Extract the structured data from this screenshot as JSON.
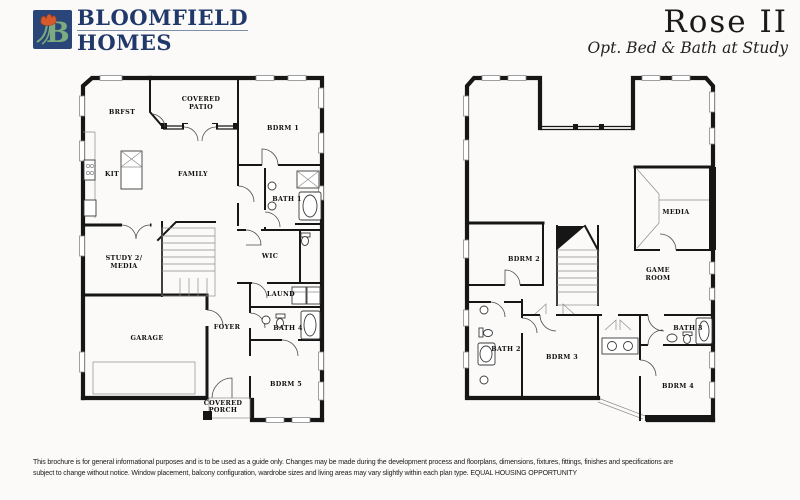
{
  "header": {
    "logo_letter": "B",
    "brand_line1": "BLOOMFIELD",
    "brand_line2": "HOMES",
    "title": "Rose II",
    "subtitle": "Opt. Bed & Bath at Study"
  },
  "floor1": {
    "rooms": {
      "brfst": "BRFST",
      "patio1": "COVERED",
      "patio2": "PATIO",
      "bdrm1": "BDRM 1",
      "kit": "KIT",
      "family": "FAMILY",
      "bath1": "BATH 1",
      "study1": "STUDY 2/",
      "study2": "MEDIA",
      "wic": "WIC",
      "laund": "LAUND",
      "garage": "GARAGE",
      "foyer": "FOYER",
      "bath4": "BATH 4",
      "bdrm5": "BDRM 5",
      "porch1": "COVERED",
      "porch2": "PORCH"
    }
  },
  "floor2": {
    "rooms": {
      "media": "MEDIA",
      "bdrm2": "BDRM 2",
      "game1": "GAME",
      "game2": "ROOM",
      "bath2": "BATH 2",
      "bdrm3": "BDRM 3",
      "bath3": "BATH 3",
      "bdrm4": "BDRM 4"
    }
  },
  "footer": {
    "line1": "This brochure is for general informational purposes and is to be used as a guide only. Changes may be made during the development process and floorplans, dimensions, fixtures, fittings, finishes and specifications are",
    "line2": "subject to change without notice. Window placement, balcony configuration, wardrobe sizes and living areas may vary slightly within each plan type.  EQUAL HOUSING OPPORTUNITY"
  },
  "colors": {
    "brand_navy": "#21386b",
    "logo_green": "#7cab7f",
    "tulip_orange": "#d65a2c",
    "wall_black": "#161616"
  }
}
